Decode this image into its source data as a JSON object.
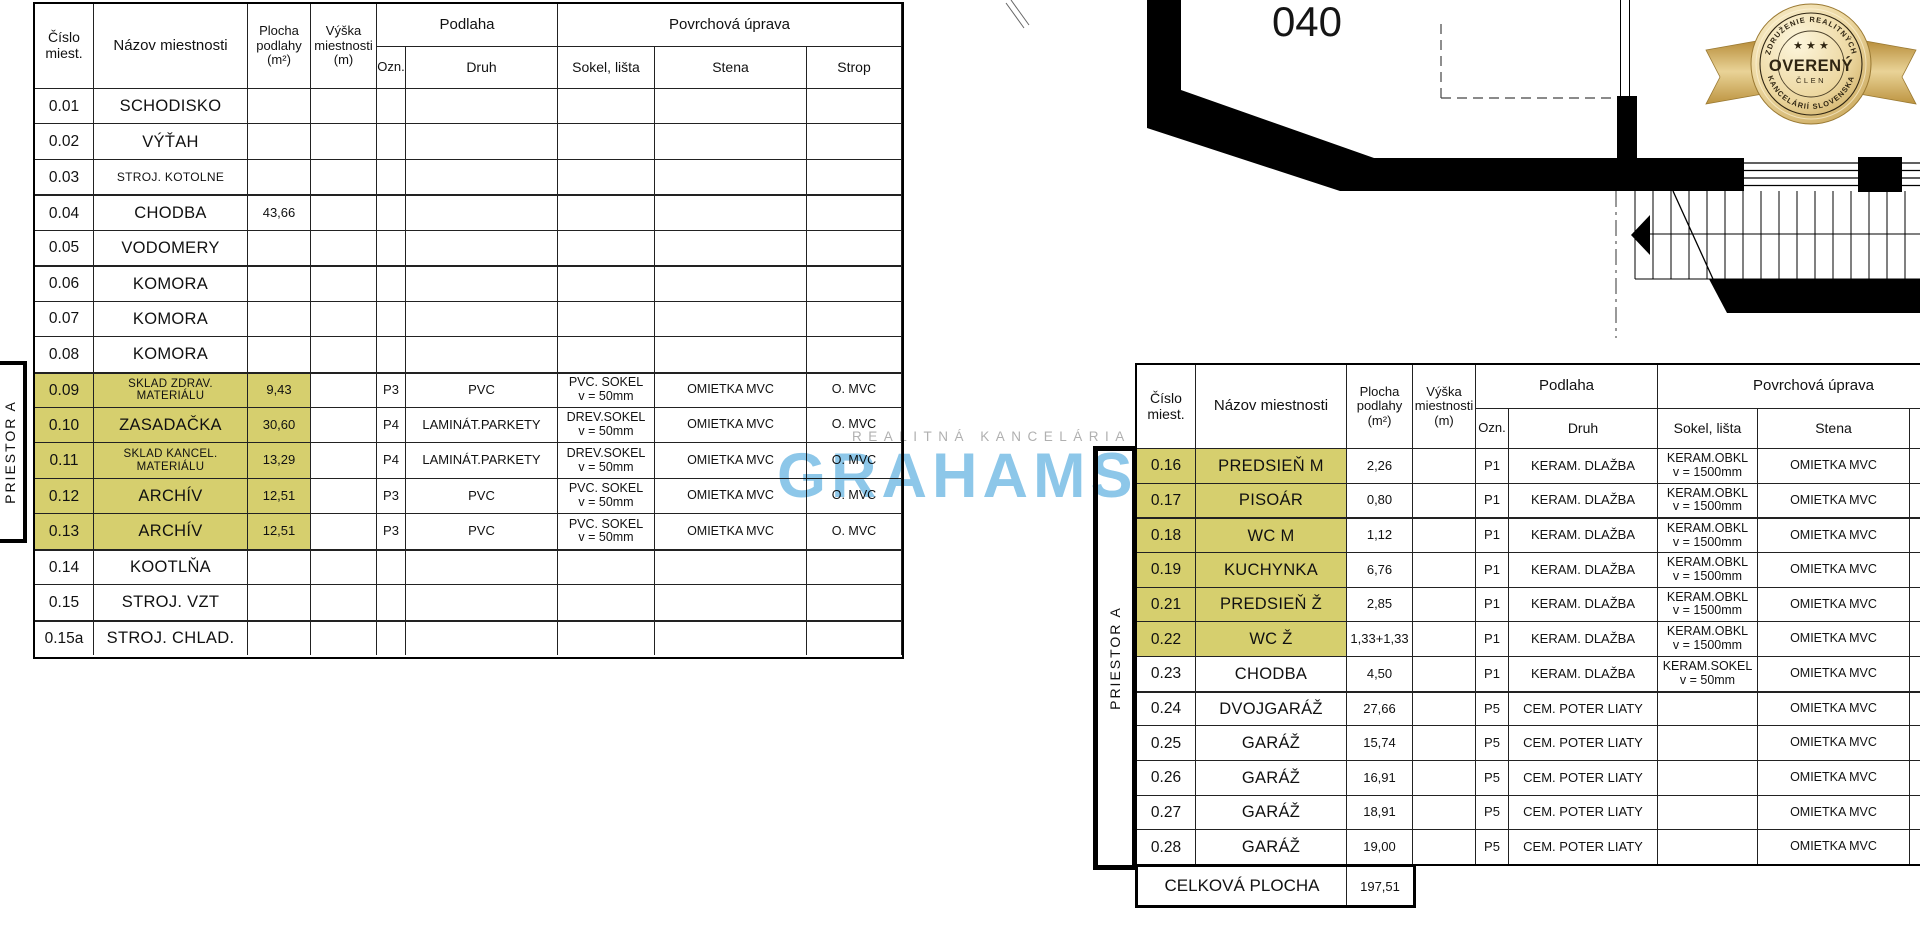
{
  "colors": {
    "highlight": "#d6cf6e",
    "brand_blue": "#8dc7e9",
    "badge_gold": "#c9a44c",
    "watermark_gray": "#b0b0b0"
  },
  "headers": {
    "cislo": "Číslo\nmiest.",
    "nazov": "Názov miestnosti",
    "plocha": "Plocha\npodlahy\n(m²)",
    "vyska": "Výška\nmiestnosti\n(m)",
    "podlaha": "Podlaha",
    "ozn": "Ozn.",
    "druh": "Druh",
    "povrch": "Povrchová úprava",
    "sokel": "Sokel, lišta",
    "stena": "Stena",
    "strop": "Strop"
  },
  "labels": {
    "priestor": "PRIESTOR A"
  },
  "left_table": {
    "rows": [
      {
        "num": "0.01",
        "name": "SCHODISKO"
      },
      {
        "num": "0.02",
        "name": "VÝŤAH"
      },
      {
        "num": "0.03",
        "name": "STROJ. KOTOLNE",
        "small": true
      },
      {
        "num": "0.04",
        "name": "CHODBA",
        "area": "43,66",
        "thick": true
      },
      {
        "num": "0.05",
        "name": "VODOMERY"
      },
      {
        "num": "0.06",
        "name": "KOMORA",
        "thick": true
      },
      {
        "num": "0.07",
        "name": "KOMORA"
      },
      {
        "num": "0.08",
        "name": "KOMORA"
      },
      {
        "num": "0.09",
        "name": "SKLAD ZDRAV.",
        "name2": "MATERIÁLU",
        "area": "9,43",
        "ozn": "P3",
        "druh": "PVC",
        "sokel": "PVC. SOKEL",
        "sokel2": "v = 50mm",
        "stena": "OMIETKA MVC",
        "strop": "O. MVC",
        "hl": true,
        "thick": true
      },
      {
        "num": "0.10",
        "name": "ZASADAČKA",
        "area": "30,60",
        "ozn": "P4",
        "druh": "LAMINÁT.PARKETY",
        "sokel": "DREV.SOKEL",
        "sokel2": "v = 50mm",
        "stena": "OMIETKA MVC",
        "strop": "O. MVC",
        "hl": true
      },
      {
        "num": "0.11",
        "name": "SKLAD KANCEL.",
        "name2": "MATERIÁLU",
        "area": "13,29",
        "ozn": "P4",
        "druh": "LAMINÁT.PARKETY",
        "sokel": "DREV.SOKEL",
        "sokel2": "v = 50mm",
        "stena": "OMIETKA MVC",
        "strop": "O. MVC",
        "hl": true
      },
      {
        "num": "0.12",
        "name": "ARCHÍV",
        "area": "12,51",
        "ozn": "P3",
        "druh": "PVC",
        "sokel": "PVC. SOKEL",
        "sokel2": "v = 50mm",
        "stena": "OMIETKA MVC",
        "strop": "O. MVC",
        "hl": true
      },
      {
        "num": "0.13",
        "name": "ARCHÍV",
        "area": "12,51",
        "ozn": "P3",
        "druh": "PVC",
        "sokel": "PVC. SOKEL",
        "sokel2": "v = 50mm",
        "stena": "OMIETKA MVC",
        "strop": "O. MVC",
        "hl": true
      },
      {
        "num": "0.14",
        "name": "KOOTLŇA",
        "thick": true
      },
      {
        "num": "0.15",
        "name": "STROJ. VZT"
      },
      {
        "num": "0.15a",
        "name": "STROJ. CHLAD.",
        "thick": true
      }
    ]
  },
  "right_table": {
    "rows": [
      {
        "num": "0.16",
        "name": "PREDSIEŇ M",
        "area": "2,26",
        "ozn": "P1",
        "druh": "KERAM.  DLAŽBA",
        "sokel": "KERAM.OBKL",
        "sokel2": "v = 1500mm",
        "stena": "OMIETKA MVC",
        "hl": true
      },
      {
        "num": "0.17",
        "name": "PISOÁR",
        "area": "0,80",
        "ozn": "P1",
        "druh": "KERAM.  DLAŽBA",
        "sokel": "KERAM.OBKL",
        "sokel2": "v = 1500mm",
        "stena": "OMIETKA MVC",
        "hl": true
      },
      {
        "num": "0.18",
        "name": "WC M",
        "area": "1,12",
        "ozn": "P1",
        "druh": "KERAM.  DLAŽBA",
        "sokel": "KERAM.OBKL",
        "sokel2": "v = 1500mm",
        "stena": "OMIETKA MVC",
        "hl": true,
        "thick": true
      },
      {
        "num": "0.19",
        "name": "KUCHYNKA",
        "area": "6,76",
        "ozn": "P1",
        "druh": "KERAM.  DLAŽBA",
        "sokel": "KERAM.OBKL",
        "sokel2": "v = 1500mm",
        "stena": "OMIETKA MVC",
        "hl": true
      },
      {
        "num": "0.21",
        "name": "PREDSIEŇ Ž",
        "area": "2,85",
        "ozn": "P1",
        "druh": "KERAM.  DLAŽBA",
        "sokel": "KERAM.OBKL",
        "sokel2": "v = 1500mm",
        "stena": "OMIETKA MVC",
        "hl": true
      },
      {
        "num": "0.22",
        "name": "WC Ž",
        "area": "1,33+1,33",
        "ozn": "P1",
        "druh": "KERAM.  DLAŽBA",
        "sokel": "KERAM.OBKL",
        "sokel2": "v = 1500mm",
        "stena": "OMIETKA MVC",
        "hl": true
      },
      {
        "num": "0.23",
        "name": "CHODBA",
        "area": "4,50",
        "ozn": "P1",
        "druh": "KERAM.  DLAŽBA",
        "sokel": "KERAM.SOKEL",
        "sokel2": "v = 50mm",
        "stena": "OMIETKA MVC"
      },
      {
        "num": "0.24",
        "name": "DVOJGARÁŽ",
        "area": "27,66",
        "ozn": "P5",
        "druh": "CEM.  POTER LIATY",
        "stena": "OMIETKA MVC",
        "thick": true
      },
      {
        "num": "0.25",
        "name": "GARÁŽ",
        "area": "15,74",
        "ozn": "P5",
        "druh": "CEM.  POTER LIATY",
        "stena": "OMIETKA MVC"
      },
      {
        "num": "0.26",
        "name": "GARÁŽ",
        "area": "16,91",
        "ozn": "P5",
        "druh": "CEM.  POTER LIATY",
        "stena": "OMIETKA MVC"
      },
      {
        "num": "0.27",
        "name": "GARÁŽ",
        "area": "18,91",
        "ozn": "P5",
        "druh": "CEM.  POTER LIATY",
        "stena": "OMIETKA MVC"
      },
      {
        "num": "0.28",
        "name": "GARÁŽ",
        "area": "19,00",
        "ozn": "P5",
        "druh": "CEM.  POTER LIATY",
        "stena": "OMIETKA MVC"
      }
    ],
    "total": {
      "label": "CELKOVÁ PLOCHA",
      "value": "197,51"
    }
  },
  "watermark": {
    "agency_line": "REALITNÁ KANCELÁRIA",
    "brand": "GRAHAMS"
  },
  "plan": {
    "room_number": "040"
  },
  "badge": {
    "arc_top": "ZDRUŽENIE REALITNÝCH",
    "arc_bottom": "KANCELÁRIÍ SLOVENSKA",
    "stars": "★ ★ ★",
    "title": "OVERENÝ",
    "subtitle": "ČLEN"
  }
}
